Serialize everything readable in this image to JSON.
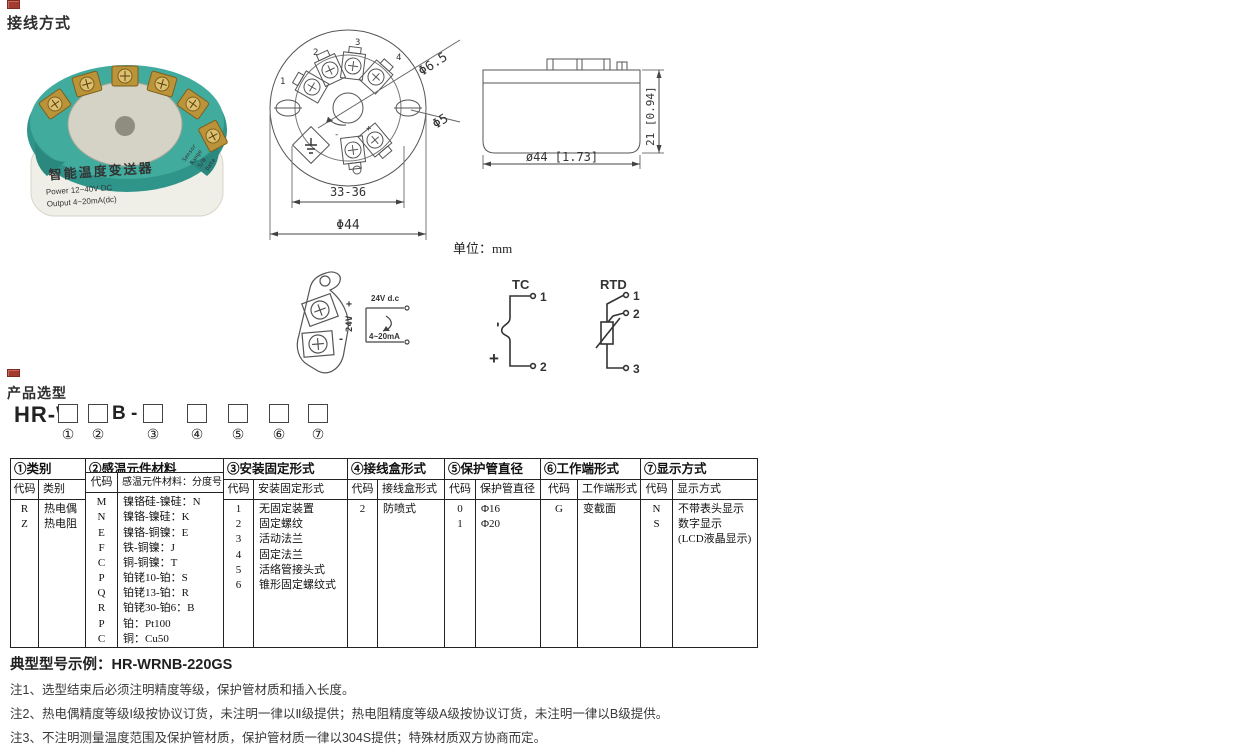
{
  "sections": {
    "wiring_title": "接线方式",
    "selection_title": "产品选型",
    "unit_label": "单位：mm"
  },
  "photo": {
    "label_title": "智能温度变送器",
    "label_line1": "Power  12~40V DC",
    "label_line2": "Output  4~20mA(dc)",
    "side_text1": "Sensor",
    "side_text2": "Range",
    "side_text3": "S/N",
    "side_text4": "Date"
  },
  "top_view": {
    "t1": "1",
    "t2": "2",
    "t3": "3",
    "t4": "4",
    "center_plus": "+",
    "center_minus": "-",
    "dim_inner": "33-36",
    "dim_outer": "Φ44",
    "dim_hole_big": "Φ6.5",
    "dim_hole_small": "Φ5"
  },
  "side_view": {
    "dim_height": "21 [0.94]",
    "dim_width": "ø44 [1.73]"
  },
  "wiring": {
    "clip_plus": "+",
    "clip_volts": "24V",
    "clip_minus": "-",
    "supply_label": "24V d.c",
    "current_label": "4~20mA",
    "tc_title": "TC",
    "tc_t1": "1",
    "tc_t2": "2",
    "tc_neg": "-",
    "tc_pos": "+",
    "rtd_title": "RTD",
    "rtd_t1": "1",
    "rtd_t2": "2",
    "rtd_t3": "3"
  },
  "model_builder": {
    "prefix": "HR-W",
    "mid_label": "B -",
    "pos1": "①",
    "pos2": "②",
    "pos3": "③",
    "pos4": "④",
    "pos5": "⑤",
    "pos6": "⑥",
    "pos7": "⑦"
  },
  "table": {
    "groups": [
      {
        "title": "①类别",
        "col1": "代码",
        "col2": "类别",
        "rows": [
          [
            "R",
            "热电偶"
          ],
          [
            "Z",
            "热电阻"
          ]
        ]
      },
      {
        "title": "②感温元件材料",
        "col1": "代码",
        "col2": "感温元件材料：分度号",
        "rows": [
          [
            "M",
            "镍铬硅-镍硅：N"
          ],
          [
            "N",
            "镍铬-镍硅：K"
          ],
          [
            "E",
            "镍铬-铜镍：E"
          ],
          [
            "F",
            "铁-铜镍：J"
          ],
          [
            "C",
            "铜-铜镍：T"
          ],
          [
            "P",
            "铂铑10-铂：S"
          ],
          [
            "Q",
            "铂铑13-铂：R"
          ],
          [
            "R",
            "铂铑30-铂6：B"
          ],
          [
            "P",
            "铂：Pt100"
          ],
          [
            "C",
            "铜：Cu50"
          ]
        ]
      },
      {
        "title": "③安装固定形式",
        "col1": "代码",
        "col2": "安装固定形式",
        "rows": [
          [
            "1",
            "无固定装置"
          ],
          [
            "2",
            "固定螺纹"
          ],
          [
            "3",
            "活动法兰"
          ],
          [
            "4",
            "固定法兰"
          ],
          [
            "5",
            "活络管接头式"
          ],
          [
            "6",
            "锥形固定螺纹式"
          ]
        ]
      },
      {
        "title": "④接线盒形式",
        "col1": "代码",
        "col2": "接线盒形式",
        "rows": [
          [
            "2",
            "防喷式"
          ]
        ]
      },
      {
        "title": "⑤保护管直径",
        "col1": "代码",
        "col2": "保护管直径",
        "rows": [
          [
            "0",
            "Φ16"
          ],
          [
            "1",
            "Φ20"
          ]
        ]
      },
      {
        "title": "⑥工作端形式",
        "col1": "代码",
        "col2": "工作端形式",
        "rows": [
          [
            "G",
            "变截面"
          ]
        ]
      },
      {
        "title": "⑦显示方式",
        "col1": "代码",
        "col2": "显示方式",
        "rows": [
          [
            "N",
            "不带表头显示"
          ],
          [
            "S",
            "数字显示"
          ],
          [
            "",
            "(LCD液晶显示)"
          ]
        ]
      }
    ]
  },
  "example_line": "典型型号示例：HR-WRNB-220GS",
  "notes": [
    "注1、选型结束后必须注明精度等级，保护管材质和插入长度。",
    "注2、热电偶精度等级I级按协议订货，未注明一律以Ⅱ级提供；热电阻精度等级A级按协议订货，未注明一律以B级提供。",
    "注3、不注明测量温度范围及保护管材质，保护管材质一律以304S提供；特殊材质双方协商而定。"
  ],
  "colors": {
    "device_teal": "#3aa79b",
    "accent_red": "#a23b30"
  }
}
